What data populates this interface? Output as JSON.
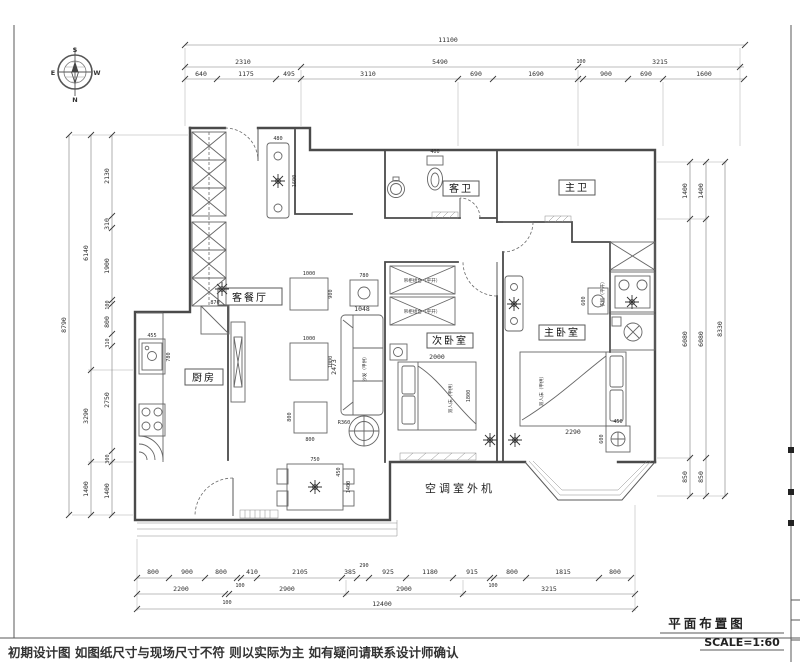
{
  "compass": {
    "s": "S",
    "n": "N",
    "e": "E",
    "w": "W"
  },
  "rooms": {
    "living_dining": "客餐厅",
    "kitchen": "厨房",
    "guest_bath": "客卫",
    "master_bath": "主卫",
    "second_bedroom": "次卧室",
    "master_bedroom": "主卧室",
    "ac_unit": "空调室外机"
  },
  "furniture": {
    "sofa": "沙发（甲供）",
    "double_bed": "双人床（甲供）",
    "closet_cell": "吊柜组合（平开）",
    "master_closet": "衣柜（平开）",
    "rug": "R360"
  },
  "dims": {
    "top": {
      "total": "11100",
      "row2": [
        "2310",
        "5490",
        "3215"
      ],
      "row3": [
        "640",
        "1175",
        "495",
        "3110",
        "690",
        "1690",
        "100",
        "900",
        "690",
        "1600"
      ]
    },
    "left": {
      "total": "8790",
      "mid": [
        "6140",
        "3290",
        "1400"
      ],
      "inner": [
        "2130",
        "310",
        "1900",
        "100",
        "800",
        "310",
        "2750",
        "300",
        "1400"
      ]
    },
    "right": {
      "total": "8330",
      "mid": [
        "1400",
        "6080",
        "850"
      ],
      "inner": [
        "1400",
        "6080",
        "850"
      ]
    },
    "bottom": {
      "total": "12400",
      "row1": [
        "800",
        "900",
        "800",
        "100",
        "410",
        "2105",
        "385",
        "290",
        "925",
        "1180",
        "915",
        "100",
        "800",
        "1815",
        "800"
      ],
      "row2": [
        "2200",
        "2900",
        "2900",
        "3215"
      ],
      "row2_extra": "100"
    },
    "furn": {
      "sofa_w": "1048",
      "sofa_d": "2473",
      "table1_w": "1000",
      "table1_d": "900",
      "table2_w": "1000",
      "table2_d": "1000",
      "table3_w": "800",
      "table3_d": "800",
      "lamp_table": "780",
      "dining_w": "750",
      "dining_l": "1400",
      "dining_c": "450",
      "bed2_w": "2000",
      "bed2_d": "1800",
      "bed1_w": "2290",
      "console_w": "480",
      "console_d": "1600",
      "cabinet": "870",
      "sink_w": "455",
      "sink_d": "780",
      "toilet": "400",
      "nightstand_w": "450",
      "nightstand_d": "600",
      "nightstand2": "600"
    }
  },
  "footer": {
    "disclaimer": "初期设计图 如图纸尺寸与现场尺寸不符 则以实际为主 如有疑问请联系设计师确认"
  },
  "title_block": {
    "title": "平面布置图",
    "scale": "SCALE=1:60"
  }
}
